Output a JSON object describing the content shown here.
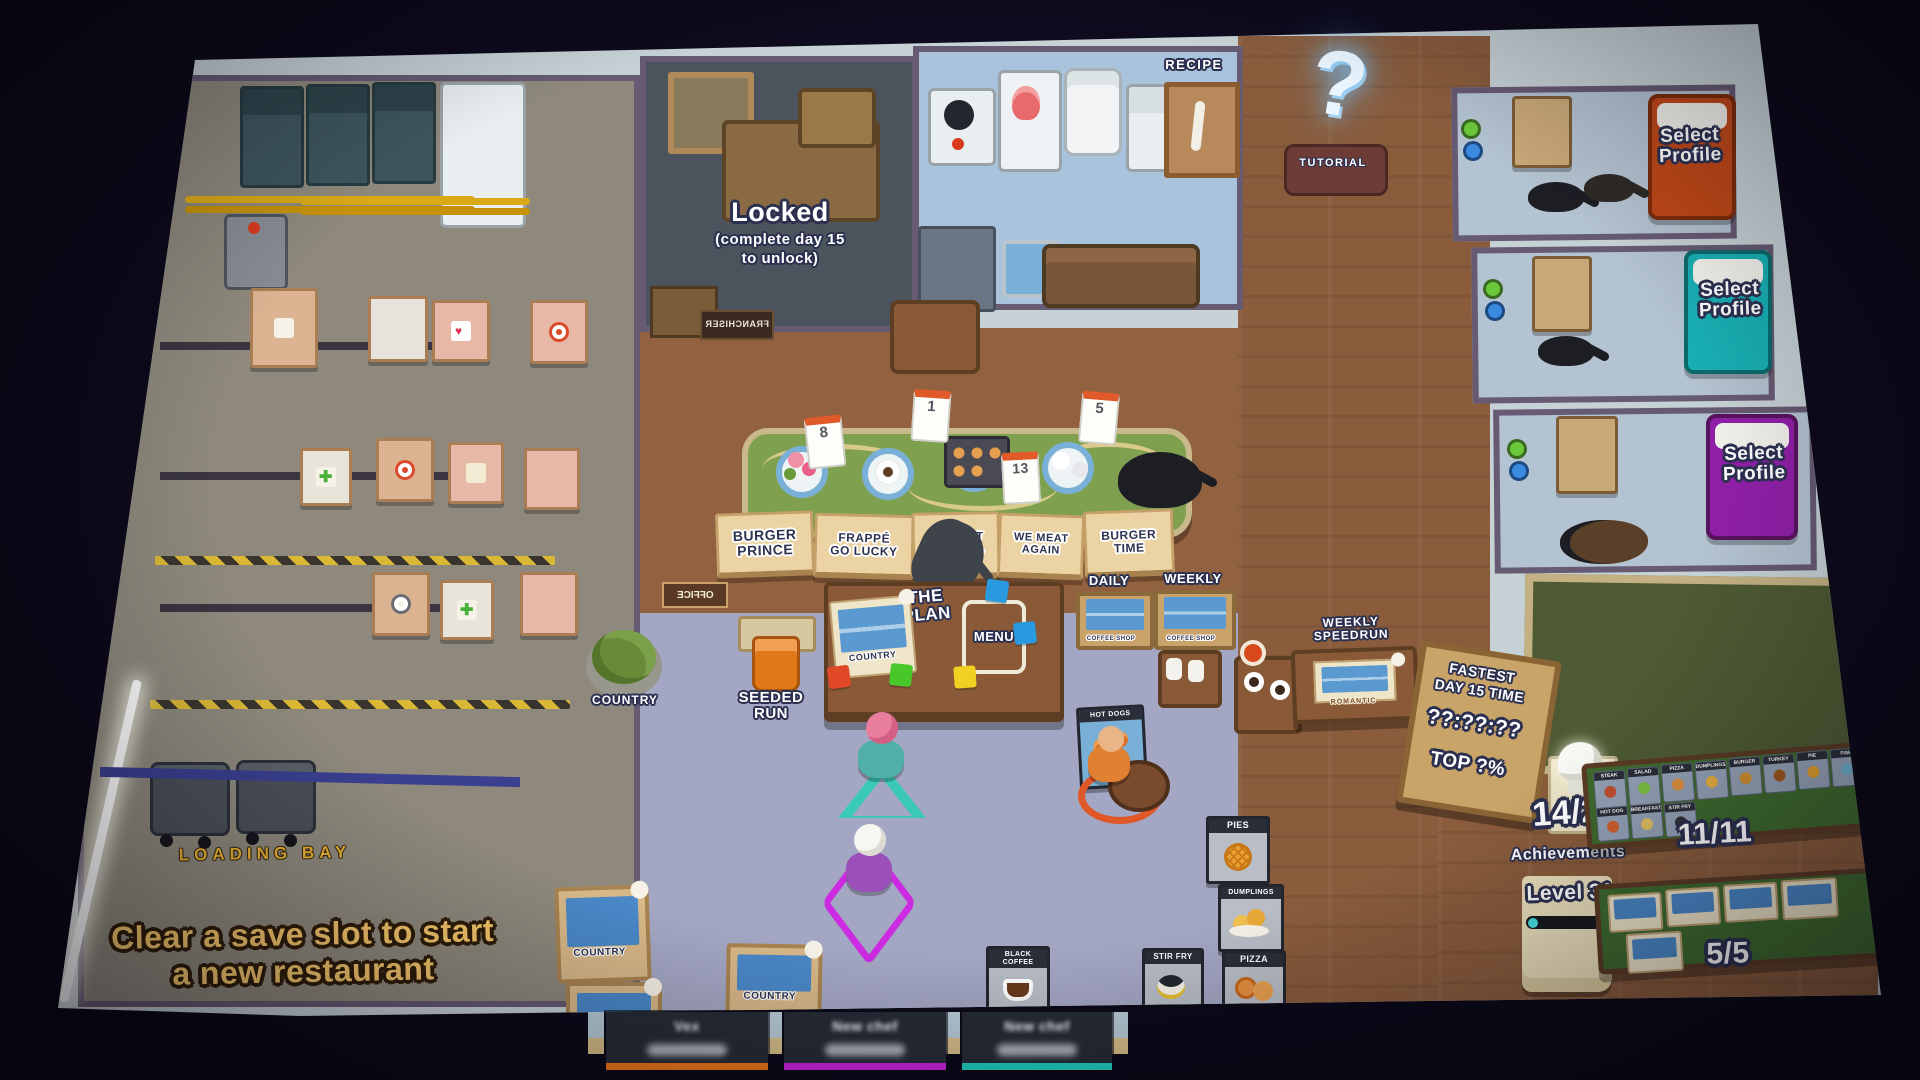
{
  "colors": {
    "accent_gold": "#f6c76a",
    "player1_underline": "#f07818",
    "player2_underline": "#cc22dd",
    "player3_underline": "#20d0c0"
  },
  "locked_room": {
    "title": "Locked",
    "subtitle_line1": "(complete day 15",
    "subtitle_line2": "to unlock)",
    "door_plaque": "FRANCHISER"
  },
  "kitchen": {
    "recipe_sign": "RECIPE"
  },
  "tutorial": {
    "mat_label": "TUTORIAL",
    "question_mark": "?"
  },
  "calendar_cards": [
    "8",
    "1",
    "13",
    "5"
  ],
  "save_slots": [
    {
      "line1": "BURGER",
      "line2": "PRINCE"
    },
    {
      "line1": "FRAPPÉ",
      "line2": "GO LUCKY"
    },
    {
      "line1": "CAUSE IT",
      "line2": "GOBLINS,"
    },
    {
      "line1": "WE MEAT",
      "line2": "AGAIN"
    },
    {
      "line1": "BURGER",
      "line2": "TIME"
    }
  ],
  "plan_desk": {
    "title_line1": "THE",
    "title_line2": "PLAN",
    "menu_label": "MENU",
    "map_card_label": "COUNTRY"
  },
  "hub_signs": {
    "seeded_run_line1": "SEEDED",
    "seeded_run_line2": "RUN",
    "country_plant": "COUNTRY",
    "office_plaque": "OFFICE"
  },
  "leaderboards": {
    "daily_label": "DAILY",
    "weekly_label": "WEEKLY",
    "daily_card": "COFFEE SHOP",
    "weekly_card": "COFFEE SHOP",
    "speedrun_line1": "WEEKLY",
    "speedrun_line2": "SPEEDRUN",
    "speedrun_card": "ROMANTIC"
  },
  "fastest_sign": {
    "line1": "FASTEST",
    "line2": "DAY 15 TIME",
    "time": "??:??:??",
    "rank": "TOP ?%"
  },
  "loading_bay": {
    "label": "LOADING BAY"
  },
  "clear_hint": {
    "line1": "Clear a save slot to start",
    "line2": "a new restaurant"
  },
  "profiles": {
    "select_line1": "Select",
    "select_line2": "Profile"
  },
  "achievements": {
    "count": "14/26",
    "label": "Achievements",
    "dish_count": "11/11",
    "dish_cards": [
      "STEAK",
      "SALAD",
      "PIZZA",
      "DUMPLINGS",
      "BURGER",
      "TURKEY",
      "PIE",
      "FISH",
      "HOT DOG",
      "BREAKFAST",
      "STIR FRY"
    ],
    "level_label": "Level 31",
    "layout_count": "5/5"
  },
  "posters": {
    "pies": "PIES",
    "dumplings": "DUMPLINGS",
    "pizza": "PIZZA",
    "stir_fry": "STIR FRY",
    "black_coffee_line1": "BLACK",
    "black_coffee_line2": "COFFEE",
    "hot_dogs": "HOT DOGS"
  },
  "country_tables": {
    "label": "COUNTRY"
  },
  "players": [
    {
      "name": "Vex"
    },
    {
      "name": "New chef"
    },
    {
      "name": "New chef"
    }
  ]
}
